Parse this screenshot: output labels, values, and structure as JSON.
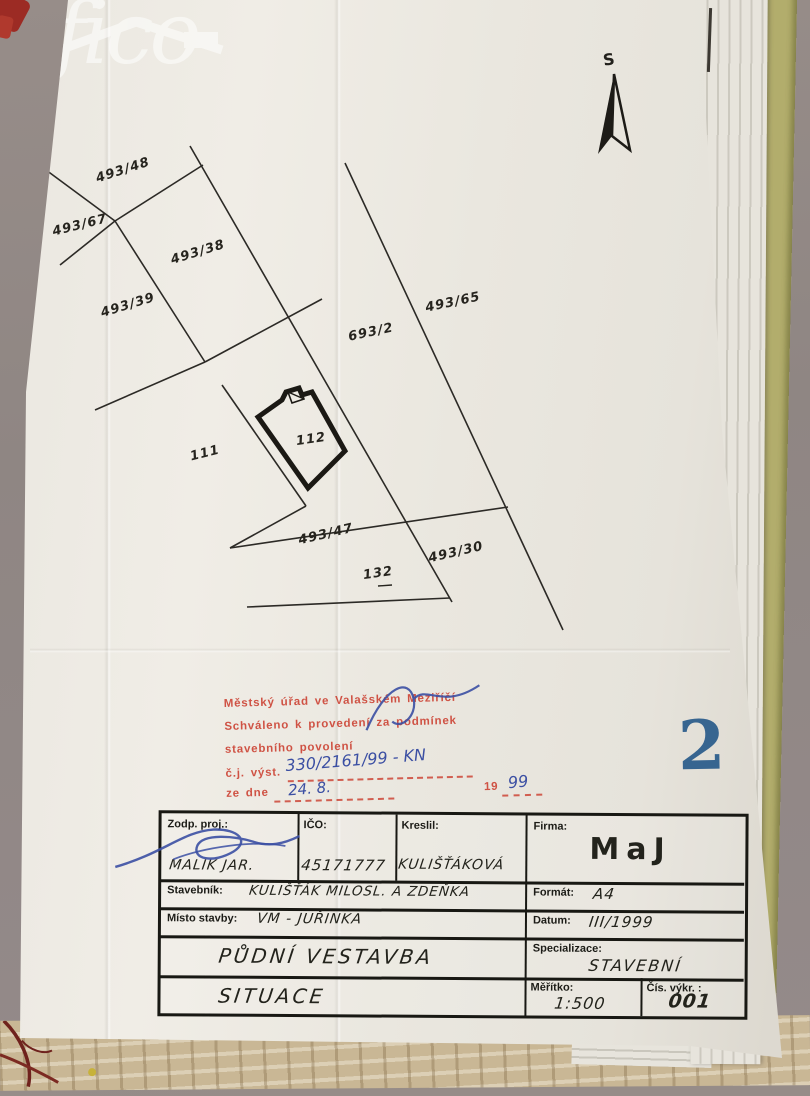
{
  "watermark": {
    "logo_text": "fico"
  },
  "north_arrow": {
    "label": "S"
  },
  "map": {
    "parcel_labels": [
      "493/48",
      "493/67",
      "493/38",
      "493/39",
      "493/65",
      "693/2",
      "111",
      "112",
      "493/47",
      "493/30",
      "132"
    ]
  },
  "stamp": {
    "line1": "Městský úřad ve Valašském Meziříčí",
    "line2": "Schváleno k provedení za podmínek",
    "line3": "stavebního povolení",
    "cj_label": "č.j. výst.",
    "cj_value": "330/2161/99 - KN",
    "date_label": "ze dne",
    "date_value": "24. 8.",
    "century": "19",
    "year": "99"
  },
  "sheet_number": "2",
  "title_block": {
    "zodp_proj_label": "Zodp. proj.:",
    "zodp_proj_value": "MALIK JAR.",
    "ico_label": "IČO:",
    "ico_value": "45171777",
    "kreslil_label": "Kreslil:",
    "kreslil_value": "KULIŠŤÁKOVÁ",
    "firma_label": "Firma:",
    "firma_value": "MaJ",
    "stavebnik_label": "Stavebník:",
    "stavebnik_value": "KULIŠŤÁK MILOSL. A ZDEŇKA",
    "misto_label": "Místo stavby:",
    "misto_value": "VM - JUŘINKA",
    "format_label": "Formát:",
    "format_value": "A4",
    "datum_label": "Datum:",
    "datum_value": "III/1999",
    "project_title": "PŮDNÍ VESTAVBA",
    "specializace_label": "Specializace:",
    "specializace_value": "STAVEBNÍ",
    "drawing_title": "SITUACE",
    "meritko_label": "Měřítko:",
    "meritko_value": "1:500",
    "cis_vykr_label": "Čís. výkr. :",
    "cis_vykr_value": "001"
  },
  "colors": {
    "paper": "#edeae2",
    "stamp_red": "#cd4637",
    "ink_blue": "#3b4fa3",
    "sheet_number_blue": "#2e5e8d",
    "map_line": "#2c2a26"
  }
}
